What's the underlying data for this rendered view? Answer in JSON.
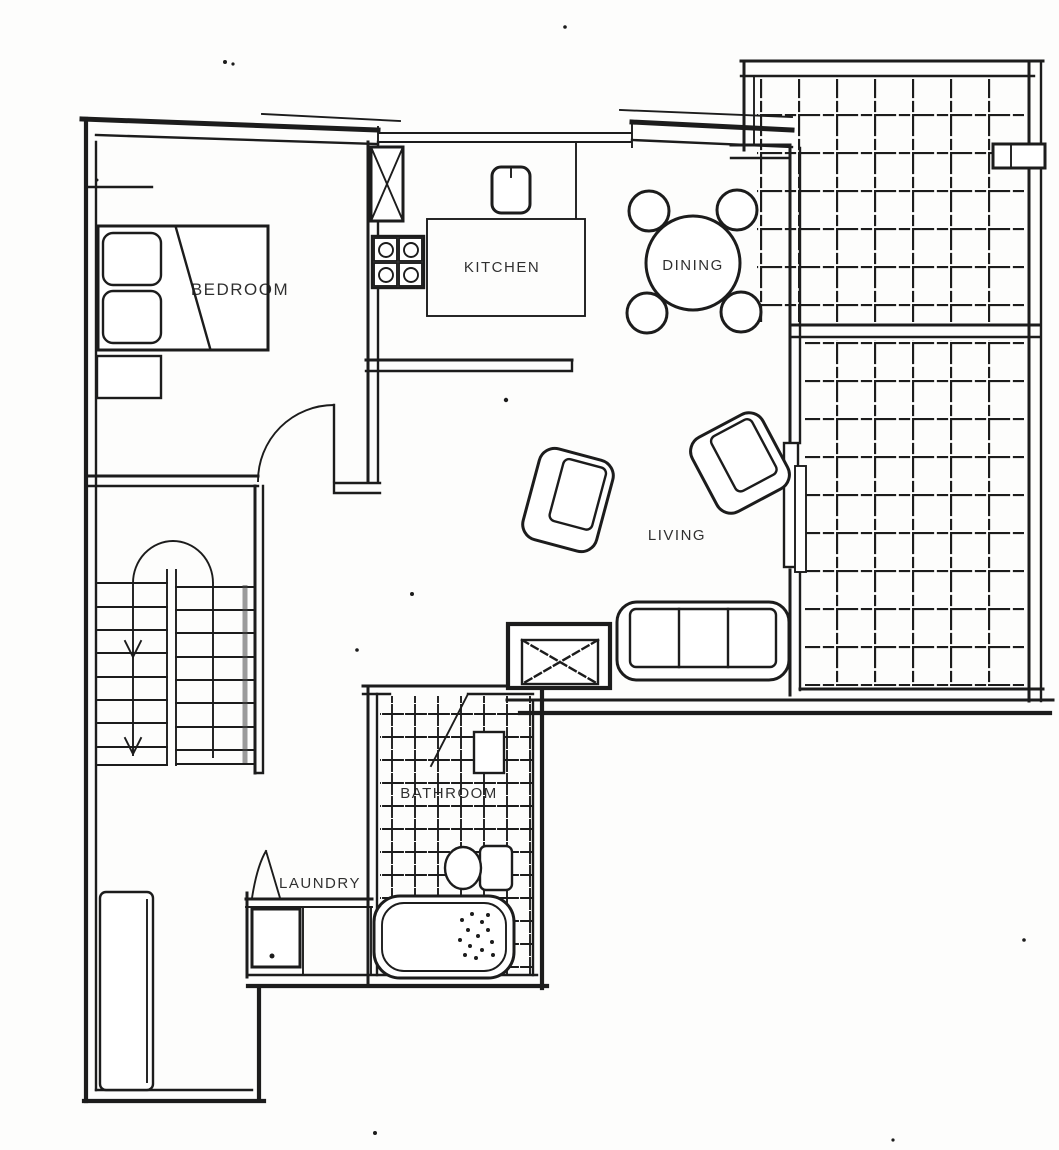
{
  "floorplan": {
    "rooms": {
      "bedroom": "BEDROOM",
      "kitchen": "KITCHEN",
      "dining": "DINING",
      "living": "LIVING",
      "bathroom": "BATHROOM",
      "laundry": "LAUNDRY"
    },
    "colors": {
      "ink": "#1c1c1c",
      "paper": "#fdfdfc"
    }
  }
}
